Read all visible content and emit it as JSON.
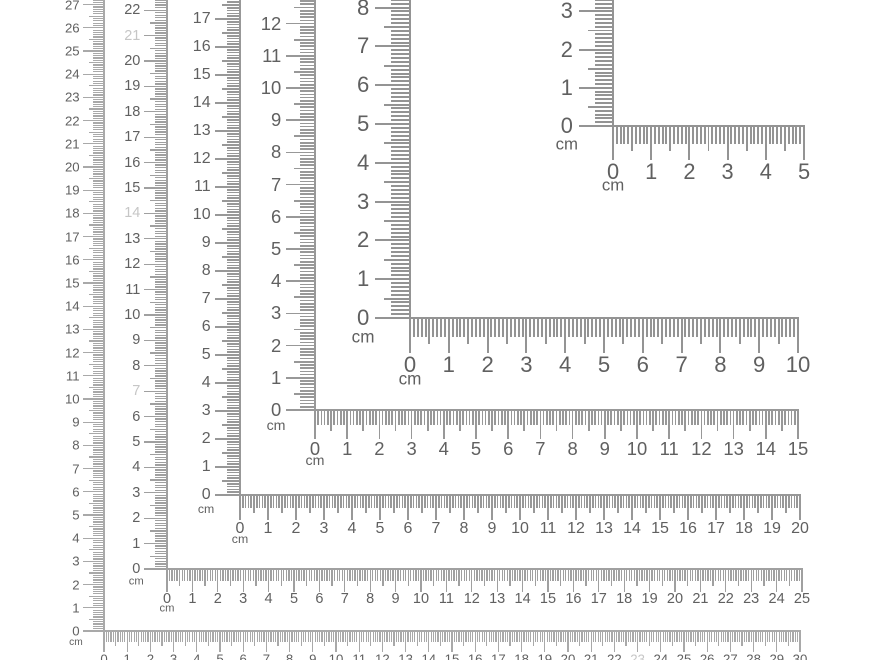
{
  "page": {
    "background_color": "#ffffff",
    "description": "Six nested L-shaped corner rulers with centimeter and millimeter markings"
  },
  "colors": {
    "tick_default": "#989898",
    "number": "#606060",
    "faded_number": "#c6c6c6"
  },
  "rulers": [
    {
      "id": "ruler-5cm",
      "length_cm": 5,
      "unit_label": "cm",
      "px_per_cm": 38.2,
      "corner": {
        "x": 613,
        "y": 126
      },
      "tick_color": "#949494",
      "horizontal_numbers": [
        0,
        1,
        2,
        3,
        4,
        5
      ],
      "vertical_numbers": [
        0,
        1,
        2,
        3
      ],
      "faded_vertical_numbers": [],
      "faded_horizontal_numbers": []
    },
    {
      "id": "ruler-10cm",
      "length_cm": 10,
      "unit_label": "cm",
      "px_per_cm": 38.8,
      "corner": {
        "x": 410,
        "y": 318
      },
      "tick_color": "#949494",
      "horizontal_numbers": [
        0,
        1,
        2,
        3,
        4,
        5,
        6,
        7,
        8,
        9,
        10
      ],
      "vertical_numbers": [
        0,
        1,
        2,
        3,
        4,
        5,
        6,
        7,
        8
      ],
      "faded_vertical_numbers": [],
      "faded_horizontal_numbers": []
    },
    {
      "id": "ruler-15cm",
      "length_cm": 15,
      "unit_label": "cm",
      "px_per_cm": 32.2,
      "corner": {
        "x": 315,
        "y": 410
      },
      "tick_color": "#989898",
      "horizontal_numbers": [
        0,
        1,
        2,
        3,
        4,
        5,
        6,
        7,
        8,
        9,
        10,
        11,
        12,
        13,
        14,
        15
      ],
      "vertical_numbers": [
        0,
        1,
        2,
        3,
        4,
        5,
        6,
        7,
        8,
        9,
        10,
        11,
        12,
        13
      ],
      "faded_vertical_numbers": [],
      "faded_horizontal_numbers": []
    },
    {
      "id": "ruler-20cm",
      "length_cm": 20,
      "unit_label": "cm",
      "px_per_cm": 28.0,
      "corner": {
        "x": 240,
        "y": 495
      },
      "tick_color": "#989898",
      "horizontal_numbers": [
        0,
        1,
        2,
        3,
        4,
        5,
        6,
        7,
        8,
        9,
        10,
        11,
        12,
        13,
        14,
        15,
        16,
        17,
        18,
        19,
        20
      ],
      "vertical_numbers": [
        0,
        1,
        2,
        3,
        4,
        5,
        6,
        7,
        8,
        9,
        10,
        11,
        12,
        13,
        14,
        15,
        16,
        17
      ],
      "faded_vertical_numbers": [],
      "faded_horizontal_numbers": []
    },
    {
      "id": "ruler-25cm",
      "length_cm": 25,
      "unit_label": "cm",
      "px_per_cm": 25.4,
      "corner": {
        "x": 167,
        "y": 569
      },
      "tick_color": "#a0a0a0",
      "horizontal_numbers": [
        0,
        1,
        2,
        3,
        4,
        5,
        6,
        7,
        8,
        9,
        10,
        11,
        12,
        13,
        14,
        15,
        16,
        17,
        18,
        19,
        20,
        21,
        22,
        23,
        24,
        25
      ],
      "vertical_numbers": [
        0,
        1,
        2,
        3,
        4,
        5,
        6,
        7,
        8,
        9,
        10,
        11,
        12,
        13,
        14,
        15,
        16,
        17,
        18,
        19,
        20,
        21,
        22
      ],
      "faded_vertical_numbers": [
        7,
        14,
        21
      ],
      "faded_horizontal_numbers": []
    },
    {
      "id": "ruler-30cm",
      "length_cm": 30,
      "unit_label": "cm",
      "px_per_cm": 23.2,
      "corner": {
        "x": 104,
        "y": 631
      },
      "tick_color": "#a9a9a9",
      "horizontal_numbers": [
        0,
        1,
        2,
        3,
        4,
        5,
        6,
        7,
        8,
        9,
        10,
        11,
        12,
        13,
        14,
        15,
        16,
        17,
        18,
        19,
        20,
        21,
        22,
        23,
        24,
        25,
        26,
        27,
        28,
        29,
        30
      ],
      "vertical_numbers": [
        0,
        1,
        2,
        3,
        4,
        5,
        6,
        7,
        8,
        9,
        10,
        11,
        12,
        13,
        14,
        15,
        16,
        17,
        18,
        19,
        20,
        21,
        22,
        23,
        24,
        25,
        26,
        27
      ],
      "faded_vertical_numbers": [],
      "faded_horizontal_numbers": [
        23
      ]
    }
  ]
}
